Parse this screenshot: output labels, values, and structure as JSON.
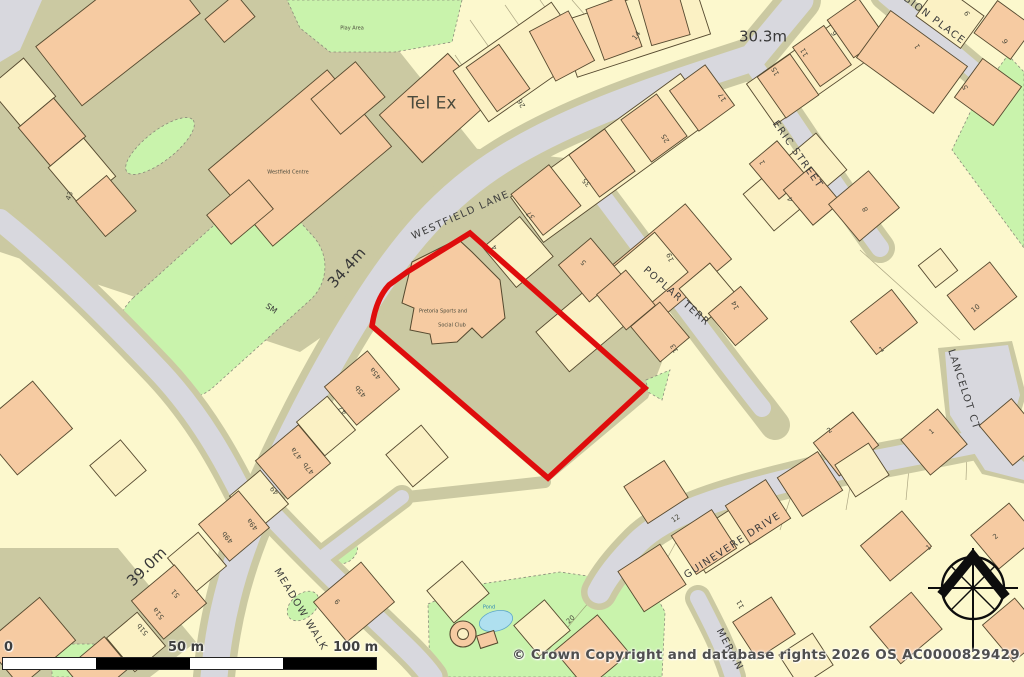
{
  "map": {
    "colors": {
      "base_parcel": "#FCF8CD",
      "road_gray": "#D8D8DE",
      "verge_olive": "#CBC9A2",
      "building_peach": "#F6CBA2",
      "building_cream": "#FBF1C4",
      "green_space": "#C9F3AC",
      "pond_blue": "#AFE0EF",
      "site_boundary_red": "#DF0D0D"
    },
    "copyright": "© Crown Copyright and database rights 2026 OS AC0000829429",
    "scale_bar": {
      "start": "0",
      "mid": "50 m",
      "end": "100 m"
    },
    "compass": {
      "name": "north-compass"
    },
    "site": {
      "name": "Pretoria Sports and Social Club",
      "boundary_color": "#DF0D0D"
    },
    "labels": [
      {
        "name": "street-westfield-lane",
        "group": "street",
        "text": "WESTFIELD LANE",
        "x": 461,
        "y": 216,
        "r": -24,
        "s": 10
      },
      {
        "name": "street-eric-street",
        "group": "street",
        "text": "ERIC STREET",
        "x": 797,
        "y": 155,
        "r": 55,
        "s": 10
      },
      {
        "name": "street-poplar-terr",
        "group": "street",
        "text": "POPLAR TERR",
        "x": 676,
        "y": 297,
        "r": 41,
        "s": 10
      },
      {
        "name": "street-albion-place",
        "group": "street",
        "text": "ALBION PLACE",
        "x": 928,
        "y": 16,
        "r": 37,
        "s": 10
      },
      {
        "name": "street-lancelot-ct",
        "group": "street",
        "text": "LANCELOT CT",
        "x": 963,
        "y": 390,
        "r": 72,
        "s": 10
      },
      {
        "name": "street-guinevere-drive",
        "group": "street",
        "text": "GUINEVERE DRIVE",
        "x": 733,
        "y": 546,
        "r": -33,
        "s": 10
      },
      {
        "name": "street-merlin",
        "group": "street",
        "text": "MERLIN",
        "x": 729,
        "y": 650,
        "r": 62,
        "s": 10
      },
      {
        "name": "street-meadow-walk",
        "group": "street",
        "text": "MEADOW WALK",
        "x": 300,
        "y": 610,
        "r": 59,
        "s": 10
      },
      {
        "name": "elevation-30-3m",
        "group": "elev",
        "text": "30.3m",
        "x": 763,
        "y": 37,
        "r": 0,
        "s": 15
      },
      {
        "name": "elevation-34-4m",
        "group": "elev",
        "text": "34.4m",
        "x": 347,
        "y": 268,
        "r": -48,
        "s": 15
      },
      {
        "name": "elevation-39-0m",
        "group": "elev",
        "text": "39.0m",
        "x": 147,
        "y": 567,
        "r": -44,
        "s": 15
      },
      {
        "name": "marker-sm",
        "group": "elev",
        "text": "SM",
        "x": 271,
        "y": 309,
        "r": 35,
        "s": 8
      },
      {
        "name": "place-tel-ex",
        "group": "place",
        "text": "Tel Ex",
        "x": 432,
        "y": 104,
        "r": 0,
        "s": 17
      },
      {
        "name": "place-westfield-centre",
        "group": "place",
        "text": "Westfield Centre",
        "x": 288,
        "y": 173,
        "r": 0,
        "s": 5
      },
      {
        "name": "place-play-area",
        "group": "place",
        "text": "Play Area",
        "x": 352,
        "y": 29,
        "r": 0,
        "s": 5
      },
      {
        "name": "place-pretoria-line1",
        "group": "place",
        "text": "Pretoria Sports and",
        "x": 443,
        "y": 312,
        "r": 0,
        "s": 5
      },
      {
        "name": "place-pretoria-line2",
        "group": "place",
        "text": "Social Club",
        "x": 452,
        "y": 326,
        "r": 0,
        "s": 5
      },
      {
        "name": "place-pond",
        "group": "place",
        "text": "Pond",
        "x": 489,
        "y": 608,
        "r": 0,
        "s": 5,
        "c": "#2e86b5"
      },
      {
        "name": "house-number-43",
        "group": "num",
        "text": "43",
        "x": 70,
        "y": 196,
        "r": -68,
        "s": 7
      },
      {
        "name": "house-number-26",
        "group": "num",
        "text": "26",
        "x": 522,
        "y": 103,
        "r": -120,
        "s": 7
      },
      {
        "name": "house-number-14",
        "group": "num",
        "text": "14",
        "x": 637,
        "y": 36,
        "r": -52,
        "s": 7
      },
      {
        "name": "house-number-35",
        "group": "num",
        "text": "35",
        "x": 587,
        "y": 182,
        "r": -132,
        "s": 7
      },
      {
        "name": "house-number-37",
        "group": "num",
        "text": "37",
        "x": 531,
        "y": 215,
        "r": -132,
        "s": 7
      },
      {
        "name": "house-number-25",
        "group": "num",
        "text": "25",
        "x": 666,
        "y": 138,
        "r": -122,
        "s": 7
      },
      {
        "name": "house-number-17",
        "group": "num",
        "text": "17",
        "x": 723,
        "y": 97,
        "r": -122,
        "s": 7
      },
      {
        "name": "house-number-15",
        "group": "num",
        "text": "15",
        "x": 776,
        "y": 71,
        "r": -120,
        "s": 7
      },
      {
        "name": "house-number-11",
        "group": "num",
        "text": "11",
        "x": 805,
        "y": 52,
        "r": -120,
        "s": 7
      },
      {
        "name": "house-number-6",
        "group": "num",
        "text": "6",
        "x": 835,
        "y": 33,
        "r": -120,
        "s": 7
      },
      {
        "name": "house-number-9",
        "group": "num",
        "text": "9",
        "x": 968,
        "y": 13,
        "r": -115,
        "s": 7
      },
      {
        "name": "house-number-1-albion",
        "group": "num",
        "text": "1",
        "x": 918,
        "y": 46,
        "r": -120,
        "s": 7
      },
      {
        "name": "house-number-5-albion",
        "group": "num",
        "text": "5",
        "x": 966,
        "y": 87,
        "r": -115,
        "s": 7
      },
      {
        "name": "house-number-6-albion",
        "group": "num",
        "text": "6",
        "x": 1006,
        "y": 41,
        "r": -115,
        "s": 7
      },
      {
        "name": "house-number-1-eric",
        "group": "num",
        "text": "1",
        "x": 763,
        "y": 162,
        "r": -115,
        "s": 7
      },
      {
        "name": "house-number-4-eric",
        "group": "num",
        "text": "4",
        "x": 791,
        "y": 199,
        "r": -115,
        "s": 7
      },
      {
        "name": "house-number-8-eric",
        "group": "num",
        "text": "8",
        "x": 866,
        "y": 209,
        "r": -115,
        "s": 7
      },
      {
        "name": "house-number-19",
        "group": "num",
        "text": "19",
        "x": 671,
        "y": 257,
        "r": -112,
        "s": 7
      },
      {
        "name": "house-number-14-poplar",
        "group": "num",
        "text": "14",
        "x": 736,
        "y": 305,
        "r": -115,
        "s": 7
      },
      {
        "name": "house-number-13",
        "group": "num",
        "text": "13",
        "x": 675,
        "y": 348,
        "r": -120,
        "s": 7
      },
      {
        "name": "house-number-5-poplar",
        "group": "num",
        "text": "5",
        "x": 584,
        "y": 262,
        "r": -132,
        "s": 7
      },
      {
        "name": "house-number-4-site",
        "group": "num",
        "text": "4",
        "x": 495,
        "y": 247,
        "r": -125,
        "s": 7
      },
      {
        "name": "house-number-10",
        "group": "num",
        "text": "10",
        "x": 976,
        "y": 309,
        "r": -38,
        "s": 7
      },
      {
        "name": "house-number-1-lancelot",
        "group": "num",
        "text": "1",
        "x": 882,
        "y": 350,
        "r": -35,
        "s": 7
      },
      {
        "name": "house-number-2-guinevere",
        "group": "num",
        "text": "2",
        "x": 830,
        "y": 431,
        "r": -38,
        "s": 7
      },
      {
        "name": "house-number-1-right",
        "group": "num",
        "text": "1",
        "x": 932,
        "y": 432,
        "r": -40,
        "s": 7
      },
      {
        "name": "house-number-2-farright",
        "group": "num",
        "text": "2",
        "x": 996,
        "y": 537,
        "r": -42,
        "s": 7
      },
      {
        "name": "house-number-1-bottomright",
        "group": "num",
        "text": "1",
        "x": 929,
        "y": 548,
        "r": -40,
        "s": 7
      },
      {
        "name": "house-number-12",
        "group": "num",
        "text": "12",
        "x": 676,
        "y": 519,
        "r": -35,
        "s": 7
      },
      {
        "name": "house-number-11-guinevere",
        "group": "num",
        "text": "11",
        "x": 741,
        "y": 604,
        "r": -118,
        "s": 7
      },
      {
        "name": "house-number-20",
        "group": "num",
        "text": "20",
        "x": 571,
        "y": 620,
        "r": -42,
        "s": 7
      },
      {
        "name": "house-number-45a",
        "group": "num",
        "text": "45a",
        "x": 376,
        "y": 373,
        "r": -130,
        "s": 7
      },
      {
        "name": "house-number-45b",
        "group": "num",
        "text": "45b",
        "x": 361,
        "y": 391,
        "r": -130,
        "s": 7
      },
      {
        "name": "house-number-47",
        "group": "num",
        "text": "47",
        "x": 343,
        "y": 410,
        "r": -130,
        "s": 7
      },
      {
        "name": "house-number-47a",
        "group": "num",
        "text": "47a",
        "x": 297,
        "y": 453,
        "r": -130,
        "s": 7
      },
      {
        "name": "house-number-47b",
        "group": "num",
        "text": "47b",
        "x": 309,
        "y": 468,
        "r": -130,
        "s": 7
      },
      {
        "name": "house-number-49",
        "group": "num",
        "text": "49",
        "x": 275,
        "y": 490,
        "r": -130,
        "s": 7
      },
      {
        "name": "house-number-49a",
        "group": "num",
        "text": "49a",
        "x": 253,
        "y": 524,
        "r": -130,
        "s": 7
      },
      {
        "name": "house-number-49b",
        "group": "num",
        "text": "49b",
        "x": 228,
        "y": 537,
        "r": -130,
        "s": 7
      },
      {
        "name": "house-number-51",
        "group": "num",
        "text": "51",
        "x": 176,
        "y": 593,
        "r": -130,
        "s": 7
      },
      {
        "name": "house-number-51a",
        "group": "num",
        "text": "51a",
        "x": 159,
        "y": 613,
        "r": -130,
        "s": 7
      },
      {
        "name": "house-number-51b",
        "group": "num",
        "text": "51b",
        "x": 143,
        "y": 629,
        "r": -130,
        "s": 7
      },
      {
        "name": "house-number-9-meadow",
        "group": "num",
        "text": "9",
        "x": 338,
        "y": 601,
        "r": -130,
        "s": 7
      }
    ]
  }
}
